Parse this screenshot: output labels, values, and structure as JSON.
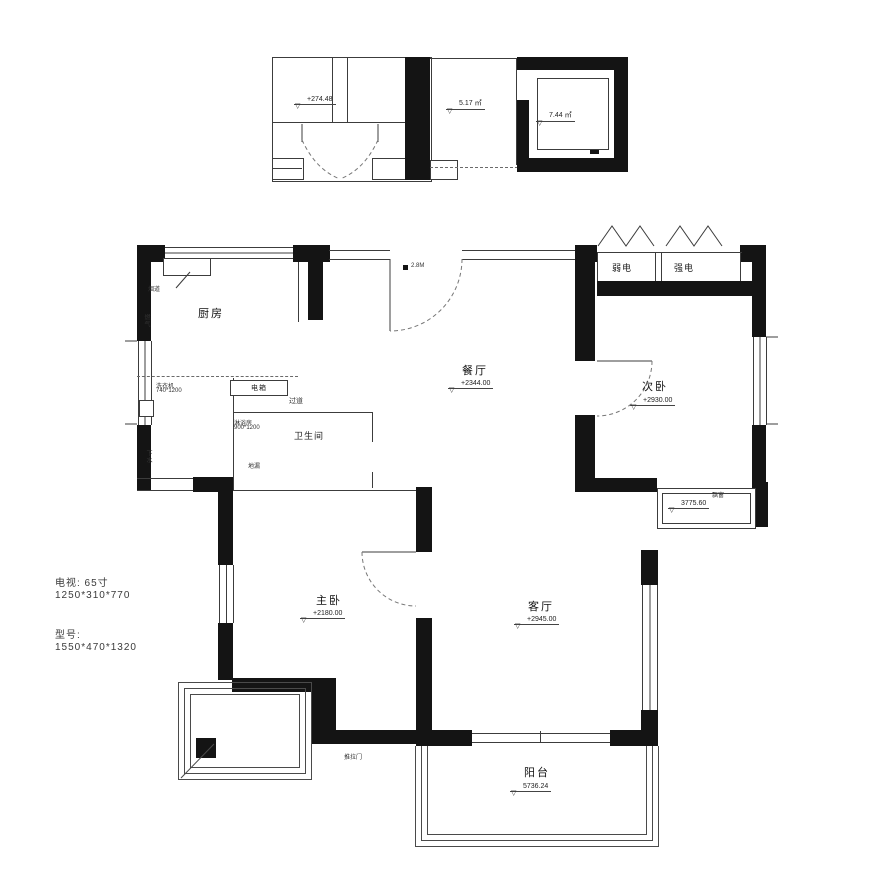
{
  "icons": {
    "level_marker": "▽"
  },
  "annex": {
    "left_level": "+274.48",
    "mid_area": "5.17 ㎡",
    "right_area": "7.44 ㎡"
  },
  "rooms": {
    "kitchen": {
      "name": "厨房"
    },
    "dining": {
      "name": "餐厅",
      "dim": "+2344.00"
    },
    "bedroom2": {
      "name": "次卧",
      "dim": "+2930.00"
    },
    "master": {
      "name": "主卧",
      "dim": "+2180.00"
    },
    "living": {
      "name": "客厅",
      "dim": "+2945.00"
    },
    "balcony": {
      "name": "阳台",
      "dim": "5736.24"
    }
  },
  "labels": {
    "bathroom": "卫生间",
    "hallway": "过道",
    "flue": "烟道",
    "gas": "燃气",
    "elec_box": "电箱",
    "washer_line1": "洗衣机",
    "washer_line2": "740*1200",
    "shower_line1": "淋浴房",
    "shower_line2": "900*1200",
    "floor_drain": "地漏",
    "drain_pipe": "下水",
    "door_height": "2.8M",
    "weak_current": "弱电",
    "strong_current": "强电",
    "bay_window": "飘窗",
    "bay_dim": "3775.60",
    "slide_door": "推拉门"
  },
  "notes": {
    "tv_label": "电视: 65寸",
    "tv_size": "1250*310*770",
    "model_label": "型号:",
    "model_size": "1550*470*1320"
  }
}
